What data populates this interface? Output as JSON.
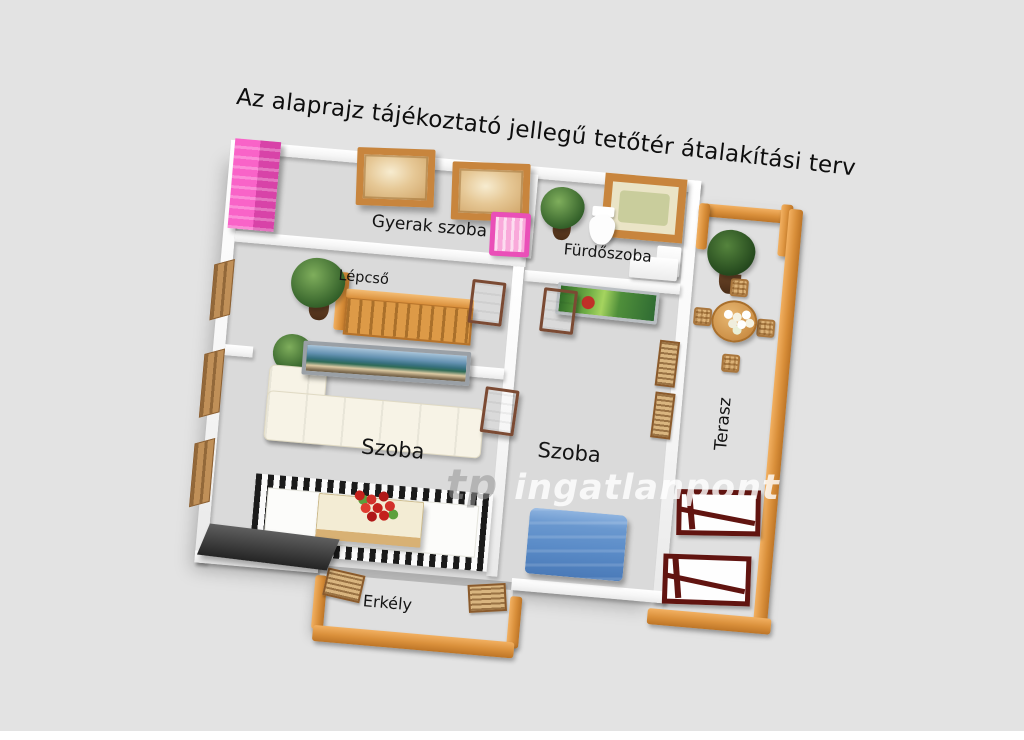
{
  "title": "Az alaprajz tájékoztató jellegű tetőtér átalakítási terv",
  "watermark": {
    "logo": "tp",
    "text": "ingatlanpont"
  },
  "labels": {
    "children_room": "Gyerak szoba",
    "bathroom": "Fürdőszoba",
    "stairs": "Lépcső",
    "room_left": "Szoba",
    "room_right": "Szoba",
    "terrace": "Terasz",
    "balcony": "Erkély"
  },
  "colors": {
    "background": "#e3e3e3",
    "floor": "#dadada",
    "wall": "#ffffff",
    "wood_accent": "#d98f3a",
    "pink_furniture": "#ee58bd",
    "bed_blue": "#5b8cc8",
    "lounge_frame_red": "#611410",
    "plant_green": "#3f6e2e",
    "rug_border": "#1b1b1b",
    "watermark_white": "rgba(255,255,255,0.8)"
  }
}
